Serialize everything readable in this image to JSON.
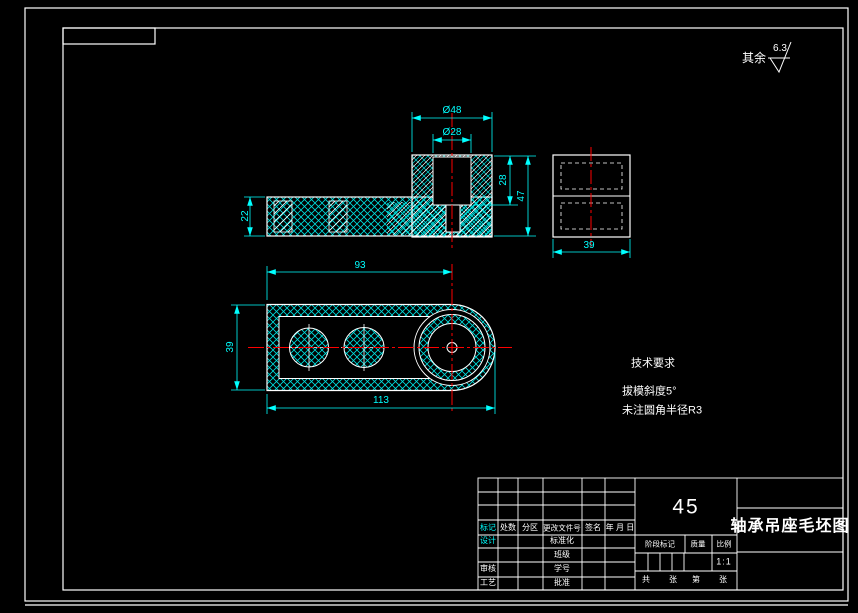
{
  "colors": {
    "background": "#000000",
    "outline": "#ffffff",
    "dimension": "#00ffff",
    "centerline": "#ff0000"
  },
  "roughness_note": {
    "label": "其余",
    "value": "6.3"
  },
  "front_view": {
    "dims": {
      "dia_outer": "Ø48",
      "dia_inner": "Ø28",
      "flange_height": "22",
      "hole_depth": "28",
      "boss_height": "47"
    }
  },
  "side_view": {
    "dims": {
      "width": "39"
    }
  },
  "plan_view": {
    "dims": {
      "center_distance": "93",
      "total_length": "113",
      "width": "39"
    }
  },
  "tech_requirements": {
    "title": "技术要求",
    "items": [
      "拔模斜度5°",
      "未注圆角半径R3"
    ]
  },
  "title_block": {
    "material": "45",
    "drawing_name": "轴承吊座毛坯图",
    "scale_value": "1:1",
    "header": {
      "mark": "标记",
      "count": "处数",
      "zone": "分区",
      "change_doc": "更改文件号",
      "signature": "签名",
      "date": "年 月 日"
    },
    "roles": {
      "design": "设计",
      "audit": "审核",
      "process": "工艺"
    },
    "fields": {
      "standardization": "标准化",
      "class": "班级",
      "student_no": "学号",
      "approve": "批准"
    },
    "stage": {
      "stage_mark": "阶段标记",
      "weight": "质量",
      "scale_label": "比例"
    },
    "sheets": {
      "total": "共",
      "sheet": "张",
      "page": "第",
      "sheet2": "张"
    }
  }
}
